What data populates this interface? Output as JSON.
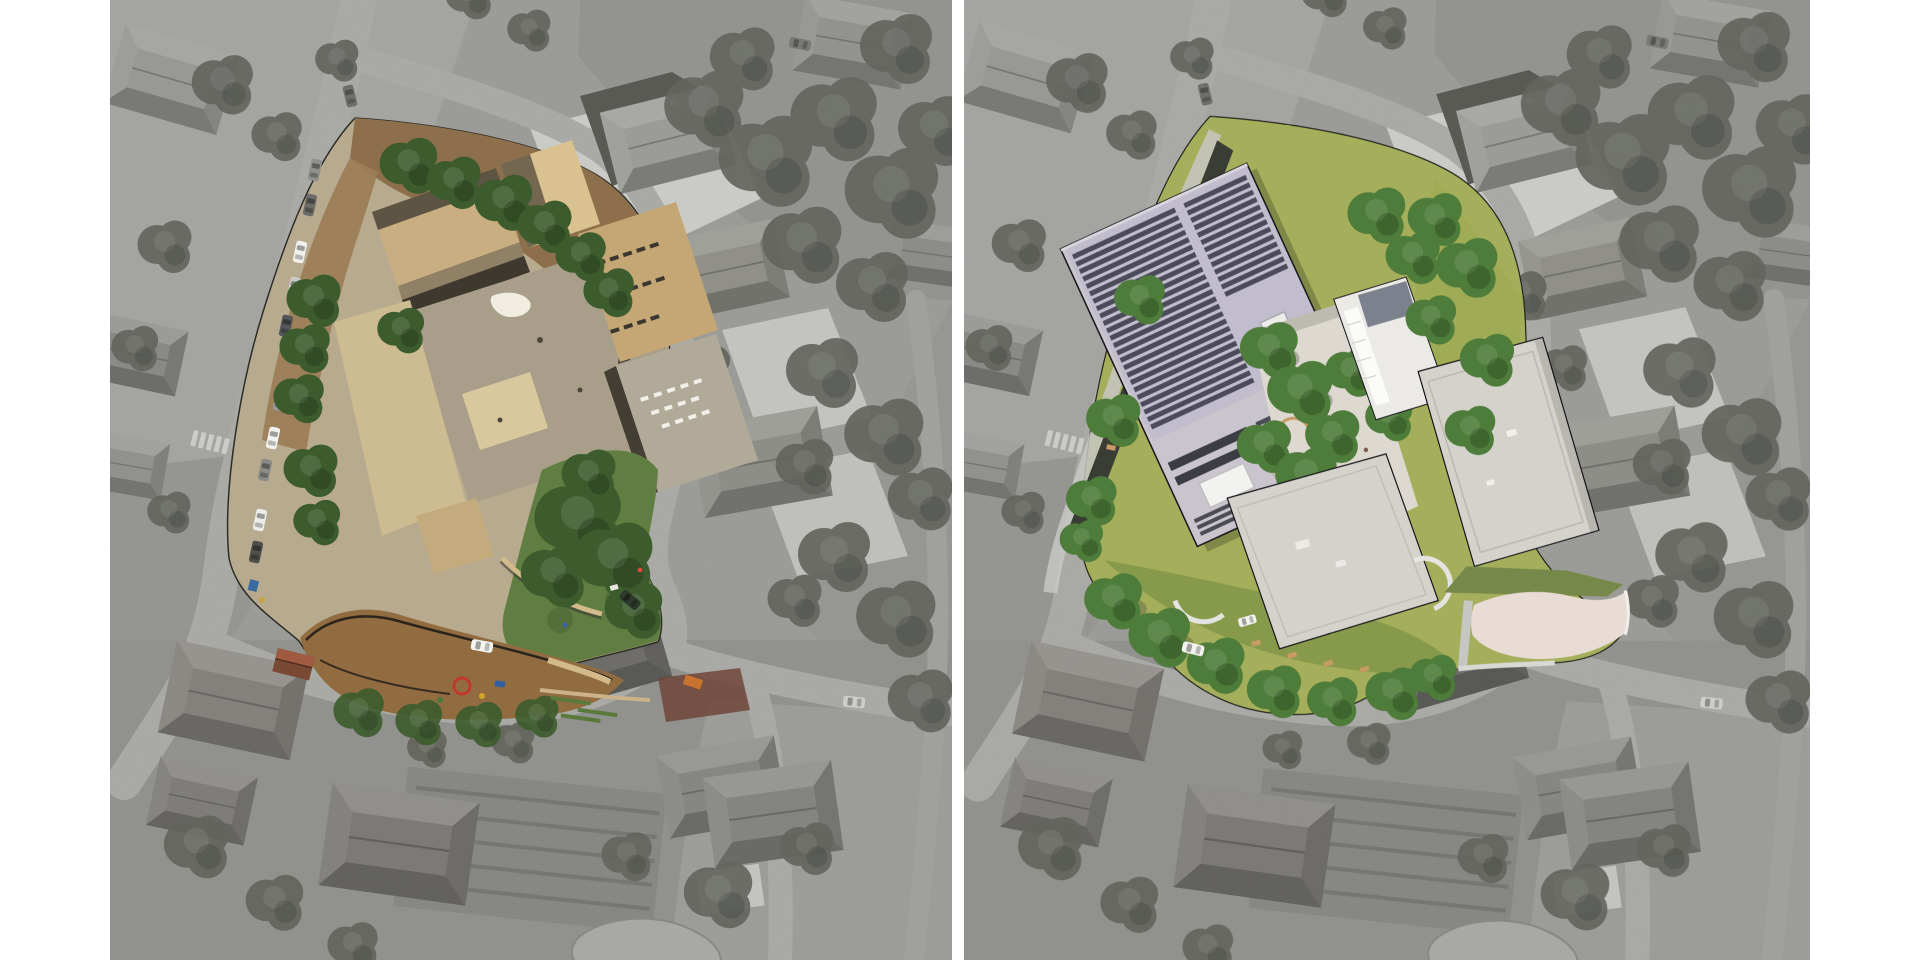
{
  "page": {
    "background": "#ffffff"
  },
  "panels": {
    "left": {
      "name": "existing-site-aerial-photo"
    },
    "right": {
      "name": "proposed-site-render"
    }
  },
  "road_markings": {
    "stop": "STOP"
  },
  "colors": {
    "pageBg": "#ffffff",
    "ground": "#a6a6a2",
    "groundLight": "#b2b2ae",
    "road": "#b8b8b4",
    "driveway": "#e1e1dd",
    "houseGray": "#96968f",
    "treeGray": "#60635a",
    "siteConcrete": "#b9aa8e",
    "dirt": "#8d6f4c",
    "roofTan": "#c9ae82",
    "roofGray": "#a89e8a",
    "lawnExisting": "#607e41",
    "playground": "#926c41",
    "treeGreenOld": "#3c5c2d",
    "shedRed": "#7a4934",
    "lawnNew": "#a5af5b",
    "lawnNewDark": "#879a4b",
    "solarBase": "#cac5cd",
    "solarPanel": "#4c4c56",
    "roofWhite": "#eceae6",
    "roofLight": "#d5d2cb",
    "courtyard": "#ddd9d0",
    "plazaPink": "#e9dcd5",
    "benchTan": "#c79a66",
    "darkBand": "#3a3d34",
    "treeGreenNew": "#4e7c3a",
    "carWhite": "#f2f2ee"
  }
}
